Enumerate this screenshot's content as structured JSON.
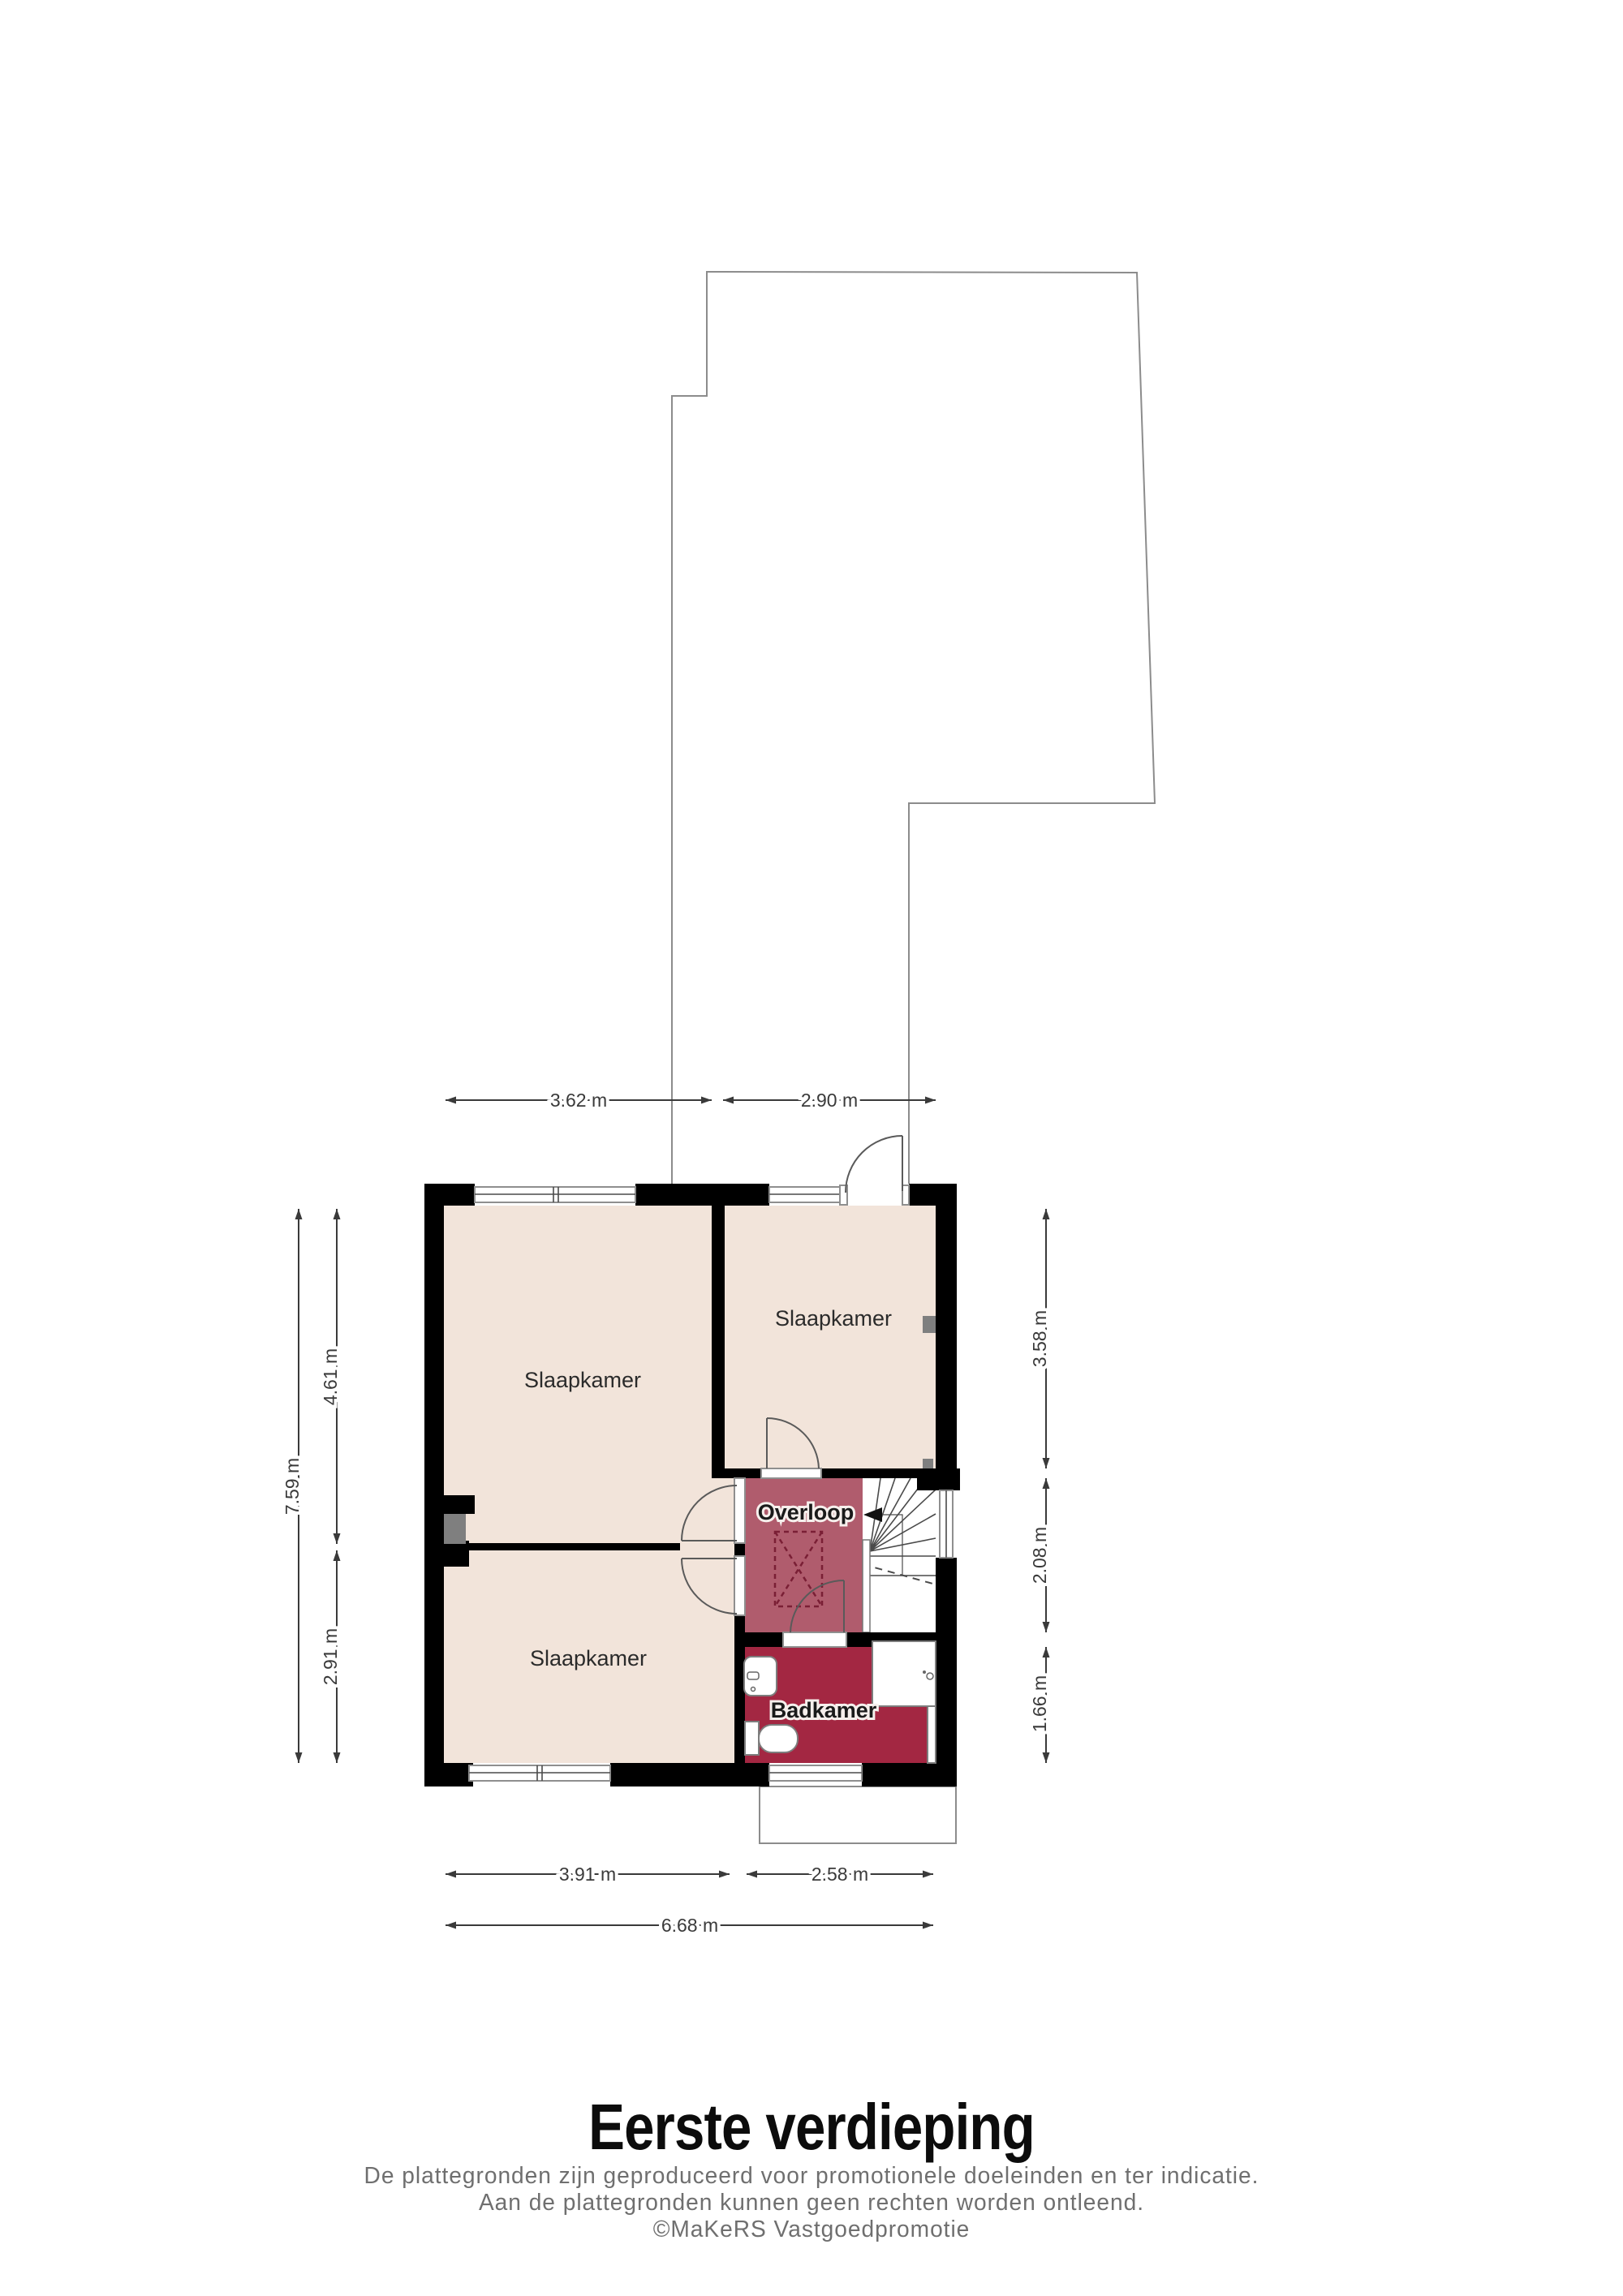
{
  "title": "Eerste verdieping",
  "disclaimer": {
    "line1": "De plattegronden zijn geproduceerd voor promotionele doeleinden en ter indicatie.",
    "line2": "Aan de plattegronden kunnen geen rechten worden ontleend.",
    "line3": "©MaKeRS Vastgoedpromotie"
  },
  "rooms": {
    "bedroom_top_left": "Slaapkamer",
    "bedroom_right": "Slaapkamer",
    "bedroom_bottom_left": "Slaapkamer",
    "landing": "Overloop",
    "bathroom": "Badkamer"
  },
  "dimensions": {
    "top_left": "3.62 m",
    "top_right": "2.90 m",
    "left_total": "7.59 m",
    "left_upper": "4.61 m",
    "left_lower": "2.91 m",
    "right_upper": "3.58 m",
    "right_middle": "2.08 m",
    "right_lower": "1.66 m",
    "bottom_left": "3.91 m",
    "bottom_right": "2.58 m",
    "bottom_total": "6.68 m"
  },
  "colors": {
    "room_fill": "#f2e4da",
    "landing_fill": "#b05c6d",
    "bathroom_fill": "#a32742",
    "wall": "#000000",
    "duct_gray": "#7f7f7f",
    "outline_stroke": "#8c8c8c",
    "dimension": "#3a3a3a"
  }
}
